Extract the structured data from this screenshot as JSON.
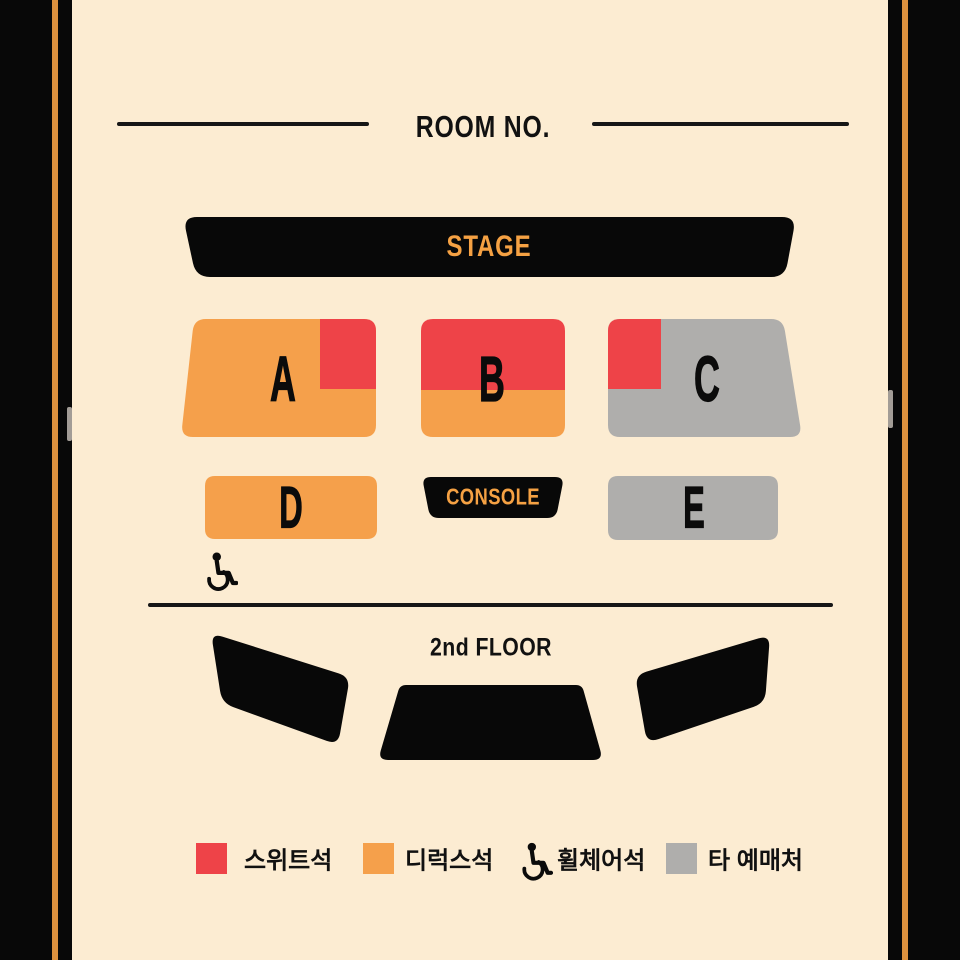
{
  "palette": {
    "background": "#FCECD2",
    "frame_black": "#080808",
    "frame_stripe_orange": "#DD913E",
    "suite_red": "#EE4348",
    "deluxe_orange": "#F5A04B",
    "other_vendor_gray": "#AFAEAC",
    "accent_text_orange": "#F5A143",
    "ink": "#141414"
  },
  "title": {
    "text": "ROOM NO."
  },
  "stage": {
    "label": "STAGE"
  },
  "sections": {
    "a": {
      "label": "A"
    },
    "b": {
      "label": "B"
    },
    "c": {
      "label": "C"
    },
    "d": {
      "label": "D"
    },
    "e": {
      "label": "E"
    },
    "console": {
      "label": "CONSOLE"
    }
  },
  "second_floor": {
    "label": "2nd FLOOR"
  },
  "legend": {
    "items": [
      {
        "swatch": "suite-red-swatch",
        "label": "스위트석"
      },
      {
        "swatch": "deluxe-orange-swatch",
        "label": "디럭스석"
      },
      {
        "swatch": "wheelchair-icon",
        "label": "휠체어석"
      },
      {
        "swatch": "other-vendor-gray-swatch",
        "label": "타 예매처"
      }
    ]
  }
}
